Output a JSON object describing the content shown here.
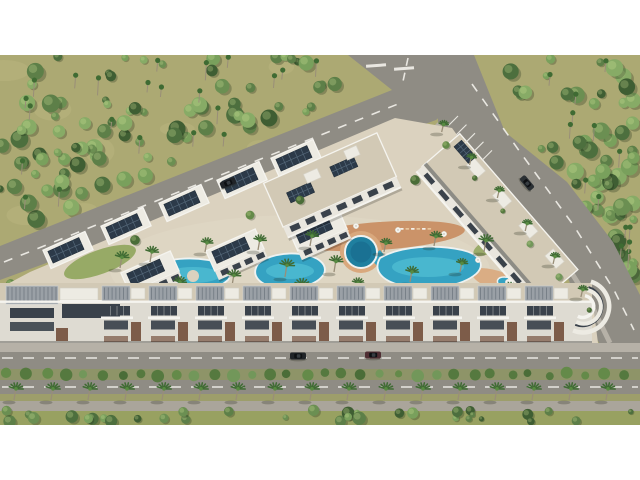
{
  "meta": {
    "title": "Aerial 3D architectural rendering of a residential resort complex",
    "render_type": "bird's-eye architectural visualization",
    "letterboxed": "white bands top and bottom"
  },
  "canvas": {
    "width": 640,
    "height": 480,
    "content_top": 55,
    "content_bottom": 425
  },
  "palette": {
    "letterbox": "#ffffff",
    "land_olive": "#aca973",
    "land_olive_light": "#bcb680",
    "forest_greens": [
      "#4d6f3e",
      "#5d7f48",
      "#6b8f52",
      "#79a05c",
      "#87ab66",
      "#3f5e33"
    ],
    "palm_green": "#3f6b33",
    "palm_green_light": "#588a42",
    "palm_trunk": "#998e78",
    "asphalt": "#8f8c84",
    "lane_white": "#e9e7e1",
    "sidewalk": "#b6b1a7",
    "plate_sand": "#dbd2bf",
    "plate_sand_light": "#e2dac8",
    "roof_beige": "#d2c9b5",
    "roof_white": "#edebe3",
    "parapet": "#f5f4ef",
    "solar_dark": "#2c3a49",
    "solar_line": "#556879",
    "facade_white": "#e9e6de",
    "facade_band": "#dedbd2",
    "glass_dark": "#3a424b",
    "pergola_grey": "#9aa0a6",
    "pergola_line": "#757d85",
    "brick_brown": "#7d5c49",
    "deck_terracotta": "#c98f64",
    "deck_light": "#d9a87d",
    "water_light": "#5ecbdc",
    "water_mid": "#35a2c2",
    "water_deep": "#1f7f9f",
    "pool_edge": "#eef2f1",
    "lawn_green": "#8fa55c",
    "median_green": "#8e9468",
    "verge_green": "#9d9e6b",
    "grass_bottom": "#98a161",
    "path_grey": "#aaa59b",
    "bush_greens": [
      "#55793f",
      "#648a49",
      "#4a6d38",
      "#72975a"
    ],
    "car_black": "#202428",
    "car_grey": "#2b3034",
    "car_maroon": "#4f2e33",
    "shadow": "rgba(35,38,25,0.26)"
  },
  "scene": {
    "forest": {
      "seed": 7,
      "top_left_trees": 85,
      "top_left_palms": 22,
      "top_right_trees": 62,
      "top_right_palms": 14,
      "greenbelt_trees": 11,
      "median_bushes": 34,
      "bottom_bushes": 34
    },
    "cars": [
      {
        "name": "car-upper-road",
        "x": 228,
        "y": 183,
        "angle": -22,
        "color_key": "car_black"
      },
      {
        "name": "car-right-road",
        "x": 527,
        "y": 183,
        "angle": 50,
        "color_key": "car_grey"
      },
      {
        "name": "car-bottom-road-black",
        "x": 298,
        "y": 356,
        "angle": 0,
        "color_key": "car_black"
      },
      {
        "name": "car-bottom-road-maroon",
        "x": 373,
        "y": 355,
        "angle": 0,
        "color_key": "car_maroon"
      }
    ],
    "palm_row": {
      "count": 17,
      "x_start": 14,
      "spacing": 37,
      "y_base": 400
    },
    "right_road_palms": 6,
    "bottom_row": {
      "units": 10,
      "x_start": 102,
      "step": 47,
      "band_right": 592
    },
    "left_wing": {
      "angle": -24,
      "row_a_centers": [
        [
          68,
          250
        ],
        [
          126,
          226
        ],
        [
          184,
          203
        ],
        [
          242,
          180
        ],
        [
          296,
          158
        ]
      ],
      "row_b_centers": [
        [
          150,
          272
        ],
        [
          235,
          250
        ],
        [
          318,
          230
        ]
      ]
    },
    "top_center_slab": {
      "cx": 330,
      "cy": 180,
      "len": 124,
      "wid": 48,
      "angle": -24
    },
    "right_wing": {
      "cx": 500,
      "cy": 218,
      "len": 180,
      "wid": 50,
      "angle": 49,
      "box_x": [
        -62,
        -22,
        18,
        58
      ]
    },
    "courtyard_palms": [
      [
        150,
        262
      ],
      [
        178,
        292
      ],
      [
        205,
        252
      ],
      [
        232,
        286
      ],
      [
        258,
        250
      ],
      [
        285,
        277
      ],
      [
        310,
        246
      ],
      [
        334,
        272
      ],
      [
        300,
        296
      ],
      [
        384,
        252
      ],
      [
        410,
        282
      ],
      [
        434,
        246
      ],
      [
        460,
        272
      ],
      [
        484,
        252
      ],
      [
        508,
        296
      ],
      [
        120,
        268
      ],
      [
        356,
        292
      ],
      [
        536,
        300
      ]
    ],
    "umbrellas": [
      [
        312,
        232
      ],
      [
        356,
        226
      ],
      [
        398,
        230
      ],
      [
        444,
        234
      ],
      [
        478,
        260
      ],
      [
        230,
        292
      ],
      [
        188,
        296
      ],
      [
        508,
        282
      ]
    ],
    "lounger_rows": [
      [
        318,
        230,
        6
      ],
      [
        400,
        228,
        6
      ],
      [
        204,
        297,
        4
      ],
      [
        432,
        291,
        4
      ]
    ],
    "complex_trees": [
      [
        135,
        240
      ],
      [
        250,
        215
      ],
      [
        300,
        200
      ],
      [
        415,
        180
      ],
      [
        430,
        300
      ],
      [
        370,
        300
      ],
      [
        250,
        300
      ],
      [
        160,
        305
      ],
      [
        540,
        320
      ],
      [
        95,
        290
      ]
    ]
  }
}
